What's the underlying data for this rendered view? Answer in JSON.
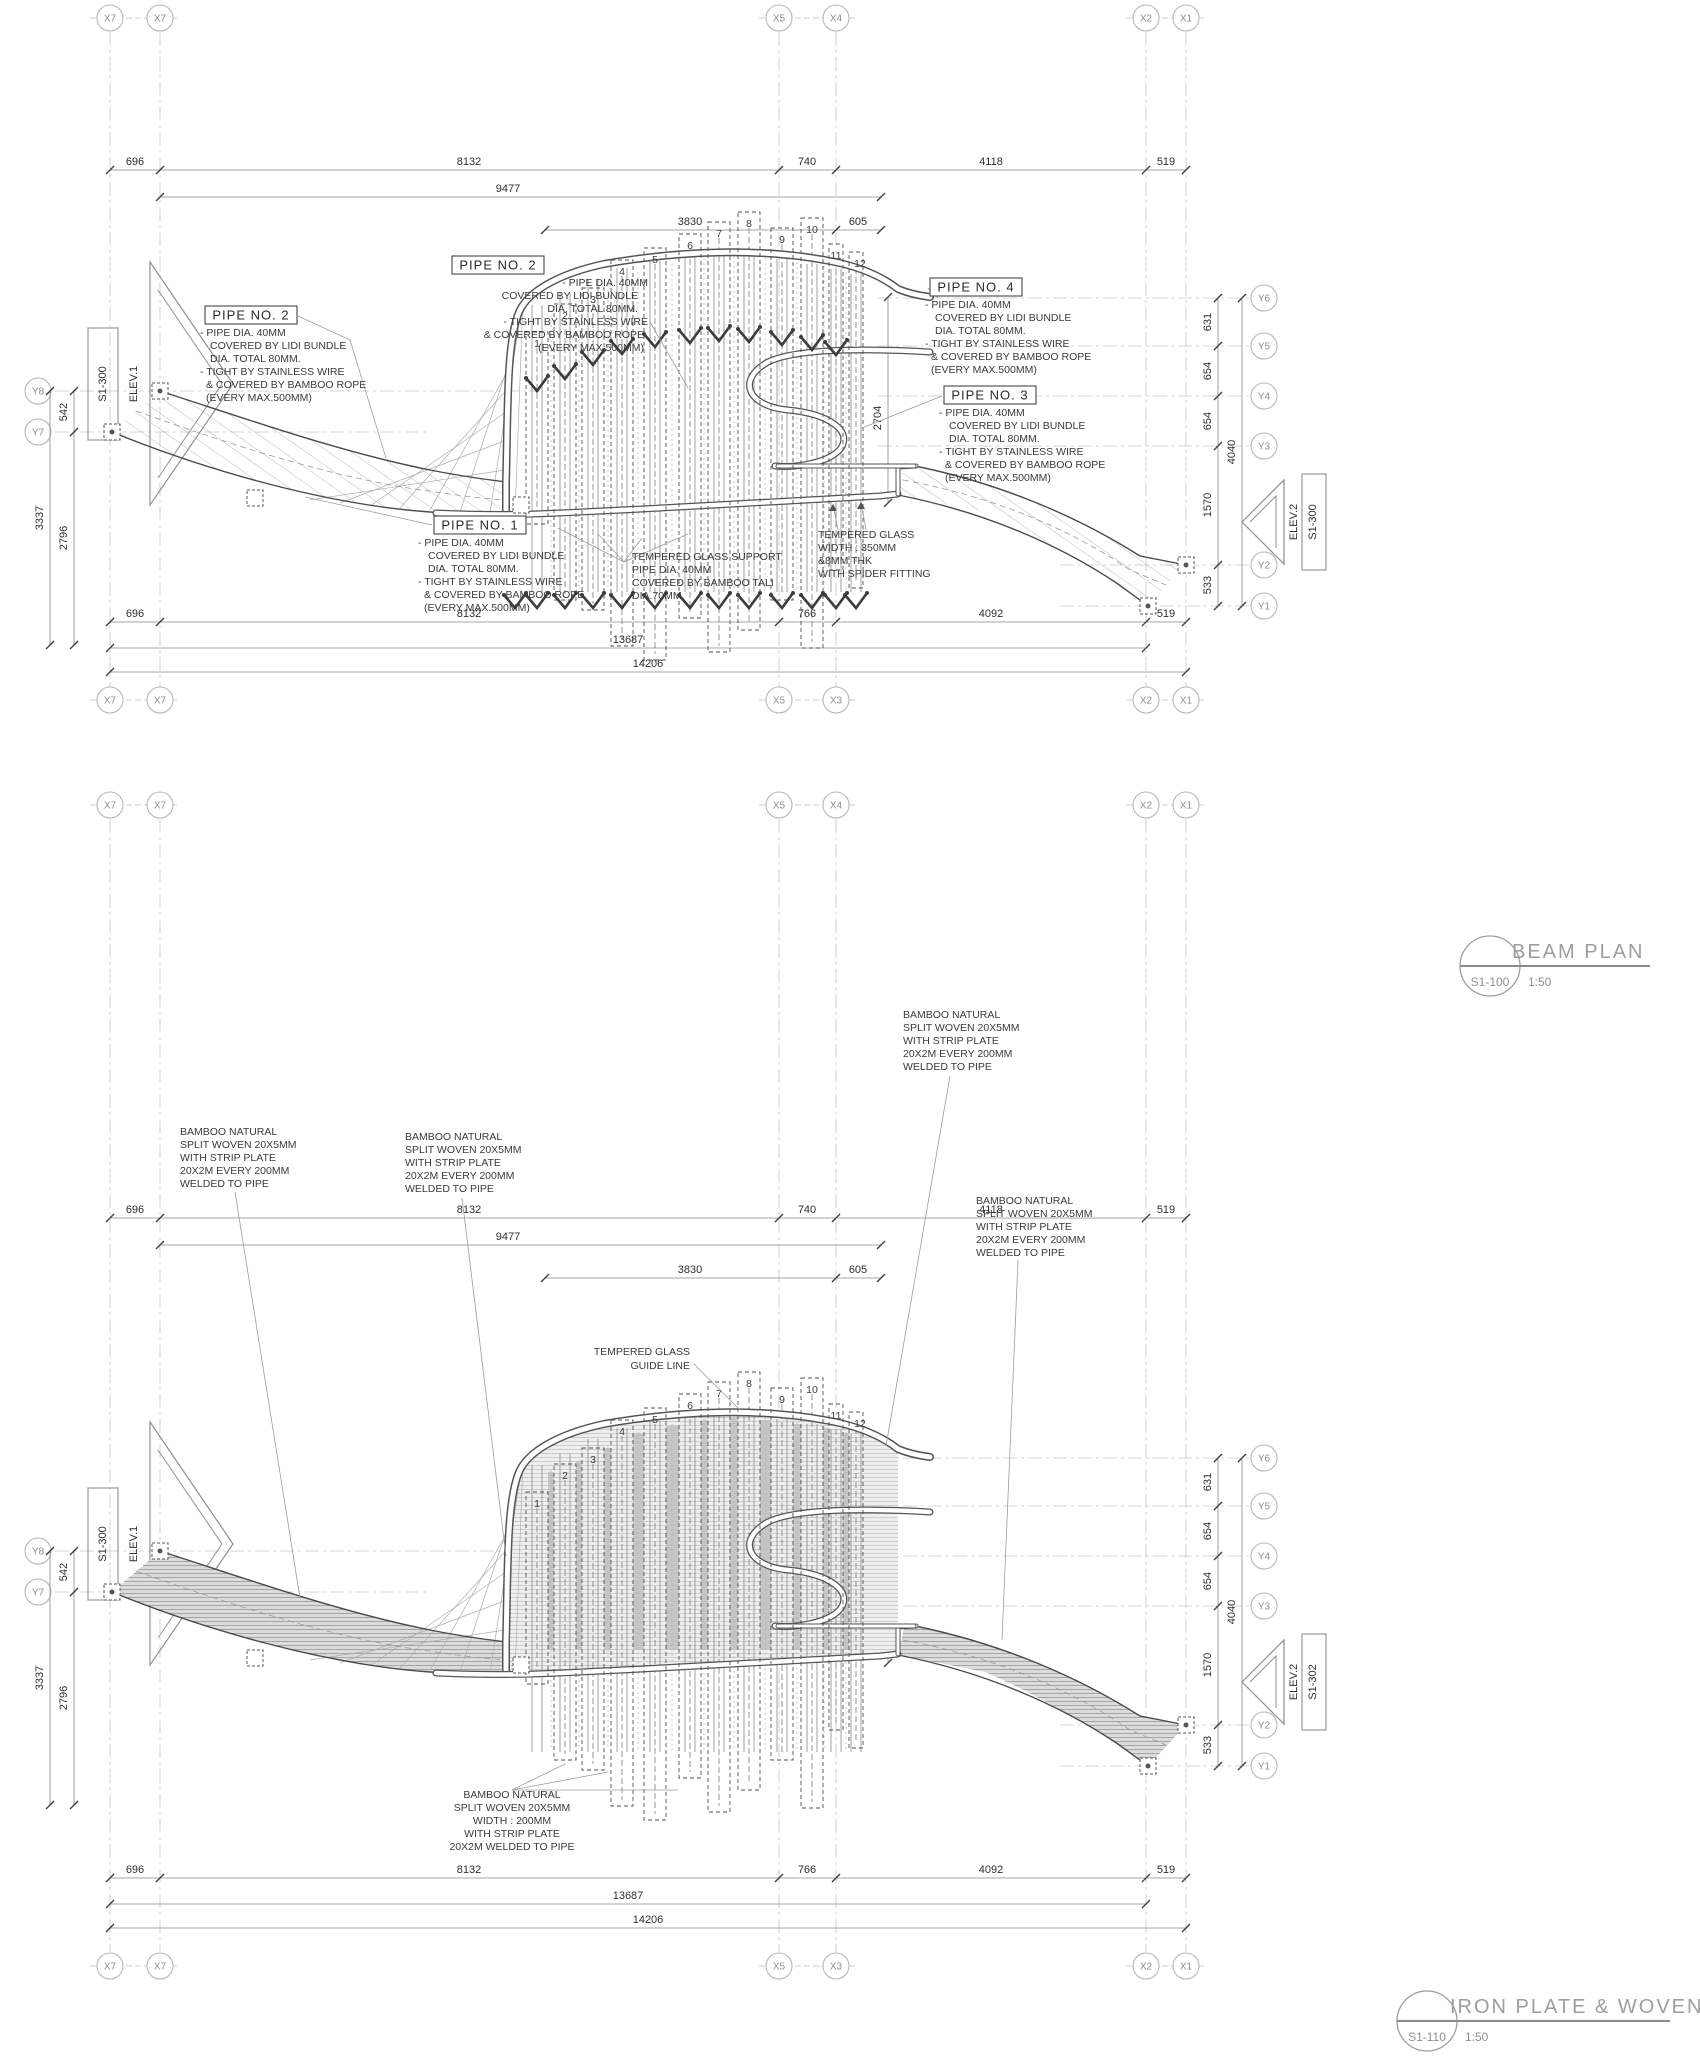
{
  "sheet_type": "structural drawing sheet",
  "grid": {
    "x_top": [
      "X7",
      "X7",
      "X5",
      "X4",
      "X2",
      "X1"
    ],
    "x_bottom": [
      "X7",
      "X7",
      "X5",
      "X3",
      "X2",
      "X1"
    ],
    "y_left": [
      "Y8",
      "Y7"
    ],
    "y_right": [
      "Y6",
      "Y5",
      "Y4",
      "Y3",
      "Y2",
      "Y1"
    ]
  },
  "dims": {
    "top_row1": [
      "696",
      "8132",
      "740",
      "4118",
      "519"
    ],
    "top_row2": "9477",
    "top_row3": [
      "3830",
      "605"
    ],
    "bottom_row1": [
      "696",
      "8132",
      "766",
      "4092",
      "519"
    ],
    "bottom_row2": "13687",
    "bottom_row3": "14206",
    "left": [
      "542",
      "3337",
      "2796"
    ],
    "right": [
      "631",
      "654",
      "654",
      "1570",
      "533"
    ],
    "right_total": "4040",
    "glass_zone": "2704"
  },
  "fins": [
    "1",
    "2",
    "3",
    "4",
    "5",
    "6",
    "7",
    "8",
    "9",
    "10",
    "11",
    "12"
  ],
  "elev": {
    "left_ref": "S1-300",
    "left_label": "ELEV.1",
    "right_label": "ELEV.2",
    "right_ref_top": "S1-300",
    "right_ref_bottom": "S1-302"
  },
  "panels": {
    "beam": {
      "title": "BEAM PLAN",
      "ref": "S1-100",
      "scale": "1:50"
    },
    "iron": {
      "title": "IRON PLATE & WOVEN",
      "ref": "S1-110",
      "scale": "1:50"
    }
  },
  "labels": {
    "pipe1": "PIPE NO. 1",
    "pipe2": "PIPE NO. 2",
    "pipe3": "PIPE NO. 3",
    "pipe4": "PIPE NO. 4",
    "pipe_spec": [
      "- PIPE DIA. 40MM",
      "COVERED BY LIDI BUNDLE",
      "DIA. TOTAL 80MM.",
      "- TIGHT BY STAINLESS WIRE",
      "& COVERED BY BAMBOO ROPE",
      "(EVERY MAX.500MM)"
    ],
    "glass_support": [
      "TEMPERED GLASS SUPPORT",
      "PIPE DIA. 40MM",
      "COVERED BY BAMBOO TALI",
      "DIA.70MM"
    ],
    "glass": [
      "TEMPERED GLASS",
      "WIDTH : 350MM",
      "&8MM THK",
      "WITH SPIDER FITTING"
    ],
    "glass_guide": [
      "TEMPERED GLASS",
      "GUIDE LINE"
    ],
    "bamboo": [
      "BAMBOO NATURAL",
      "SPLIT WOVEN 20X5MM",
      "WITH STRIP PLATE",
      "20X2M EVERY 200MM",
      "WELDED TO PIPE"
    ],
    "bamboo_width": [
      "BAMBOO NATURAL",
      "SPLIT WOVEN 20X5MM",
      "WIDTH : 200MM",
      "WITH STRIP PLATE",
      "20X2M WELDED TO PIPE"
    ]
  },
  "colors": {
    "line_dark": "#4a4a4a",
    "grid_gray": "#c6c6c6",
    "bubble_gray": "#b8b8b8",
    "title_gray": "#9e9e9e",
    "woven_fill": "#dcdcdc",
    "strip_fill": "#c2c2c2"
  }
}
